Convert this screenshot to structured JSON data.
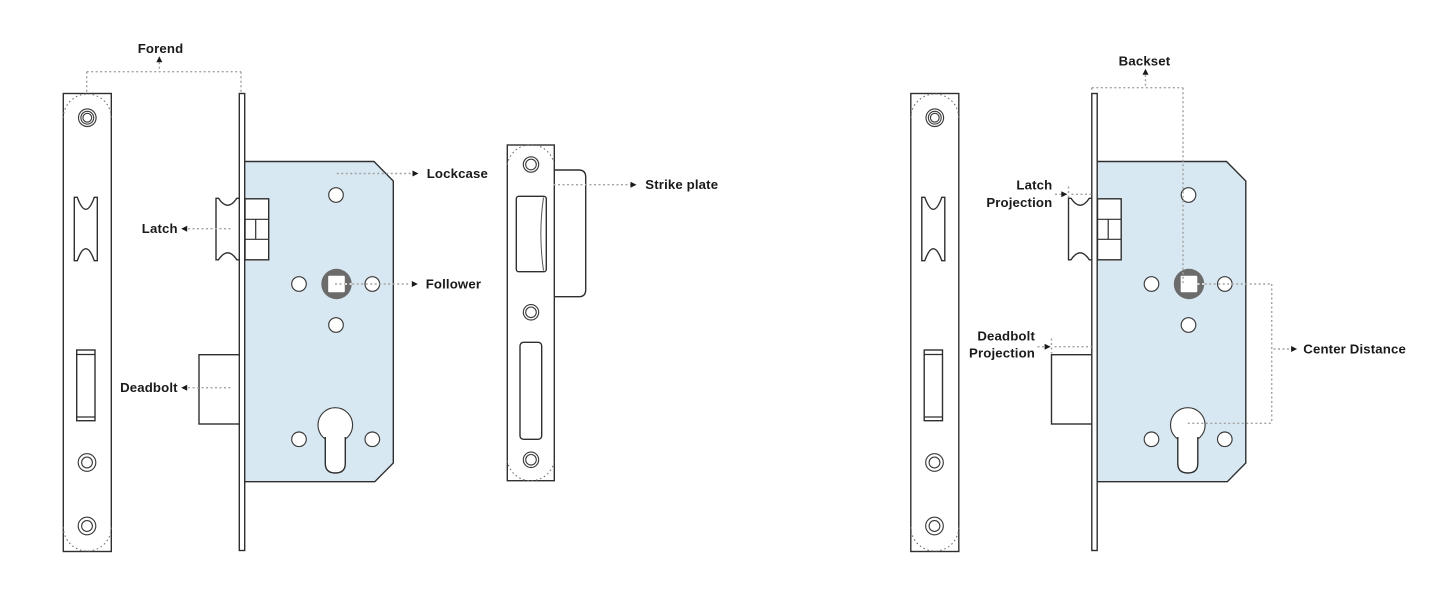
{
  "left": {
    "labels": {
      "forend": "Forend",
      "latch": "Latch",
      "deadbolt": "Deadbolt",
      "lockcase": "Lockcase",
      "follower": "Follower",
      "strike_plate": "Strike plate"
    }
  },
  "right": {
    "labels": {
      "backset": "Backset",
      "latch_projection": {
        "line1": "Latch",
        "line2": "Projection"
      },
      "deadbolt_projection": {
        "line1": "Deadbolt",
        "line2": "Projection"
      },
      "center_distance": "Center Distance"
    }
  },
  "colors": {
    "background": "#ffffff",
    "lockcase_fill": "#d8e8f2",
    "follower_gray": "#6b6b6b",
    "outline": "#2f2f2f",
    "leader_dotted": "#a3a3a3",
    "text": "#1a1a1a"
  }
}
